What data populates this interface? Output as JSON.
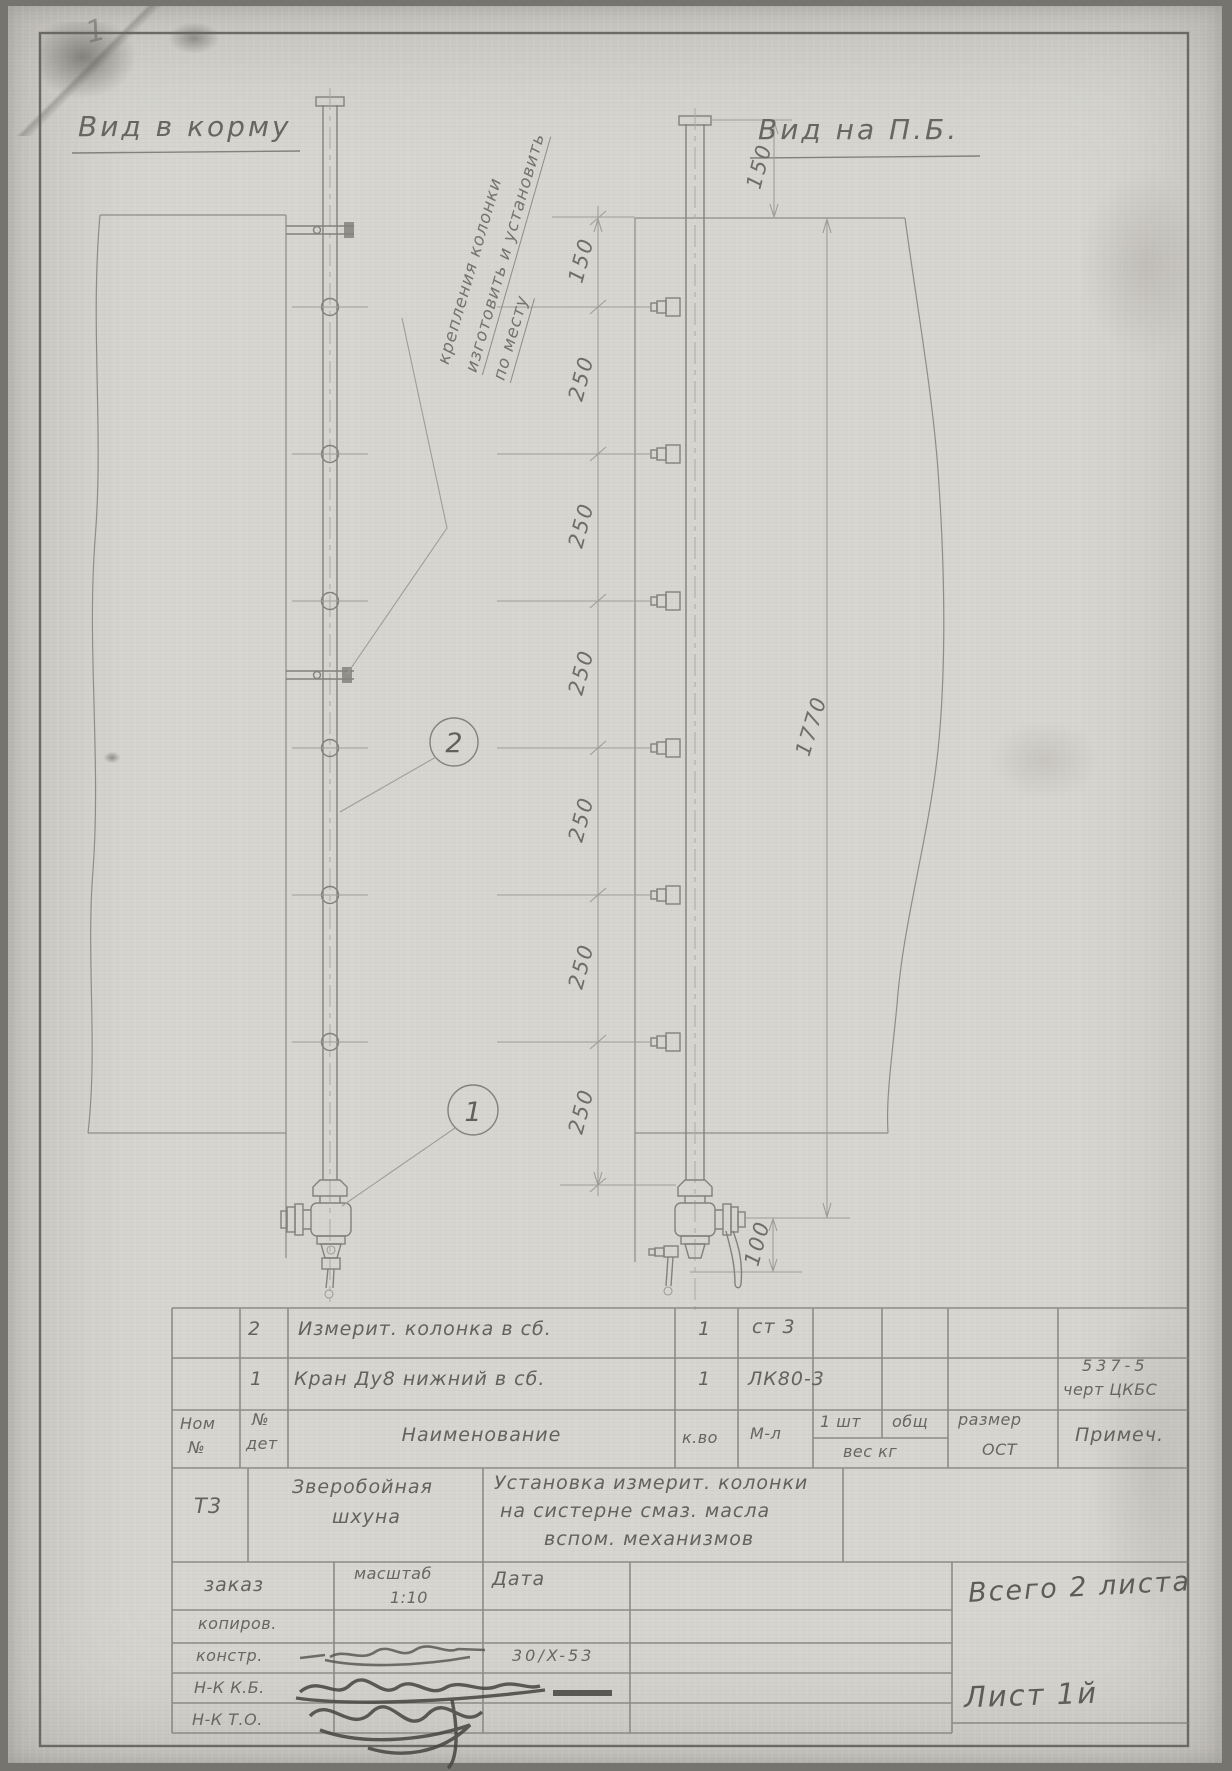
{
  "page": {
    "corner_mark": "1"
  },
  "views": {
    "left_title": "Вид в корму",
    "right_title": "Вид на П.Б."
  },
  "note_lines": [
    "крепления колонки",
    "изготовить и установить",
    "по месту"
  ],
  "callouts": {
    "column": "2",
    "valve": "1"
  },
  "dims": {
    "cap_to_deck": "150",
    "chain": [
      "150",
      "250",
      "250",
      "250",
      "250",
      "250",
      "250"
    ],
    "overall": "1770",
    "valve_offset": "100"
  },
  "title_block": {
    "rows": [
      {
        "det": "2",
        "name": "Измерит. колонка в сб.",
        "qty": "1",
        "mat": "ст 3",
        "note1": "",
        "note2": ""
      },
      {
        "det": "1",
        "name": "Кран Ду8 нижний в сб.",
        "qty": "1",
        "mat": "ЛК80-3",
        "note1": "537-5",
        "note2": "черт ЦКБС"
      }
    ],
    "header": {
      "nom1": "Ном",
      "nom2": "№",
      "det1": "№",
      "det2": "дет",
      "name": "Наименование",
      "qty": "к.во",
      "mat": "М-л",
      "per1": "1 шт",
      "per2": "общ",
      "weight": "вес кг",
      "size1": "размер",
      "size2": "ОСТ",
      "note": "Примеч."
    },
    "project": {
      "code": "Т3",
      "ship1": "Зверобойная",
      "ship2": "шхуна",
      "desc1": "Установка измерит. колонки",
      "desc2": "на систерне смаз. масла",
      "desc3": "вспом. механизмов"
    },
    "admin": {
      "order": "заказ",
      "scale_label": "масштаб",
      "scale": "1:10",
      "date_label": "Дата",
      "copy": "копиров.",
      "design": "констр.",
      "design_date": "30/X-53",
      "nkkb": "Н-К К.Б.",
      "nkto": "Н-К Т.О."
    },
    "sheets": {
      "total": "Всего 2 листа",
      "current": "Лист 1й"
    }
  }
}
